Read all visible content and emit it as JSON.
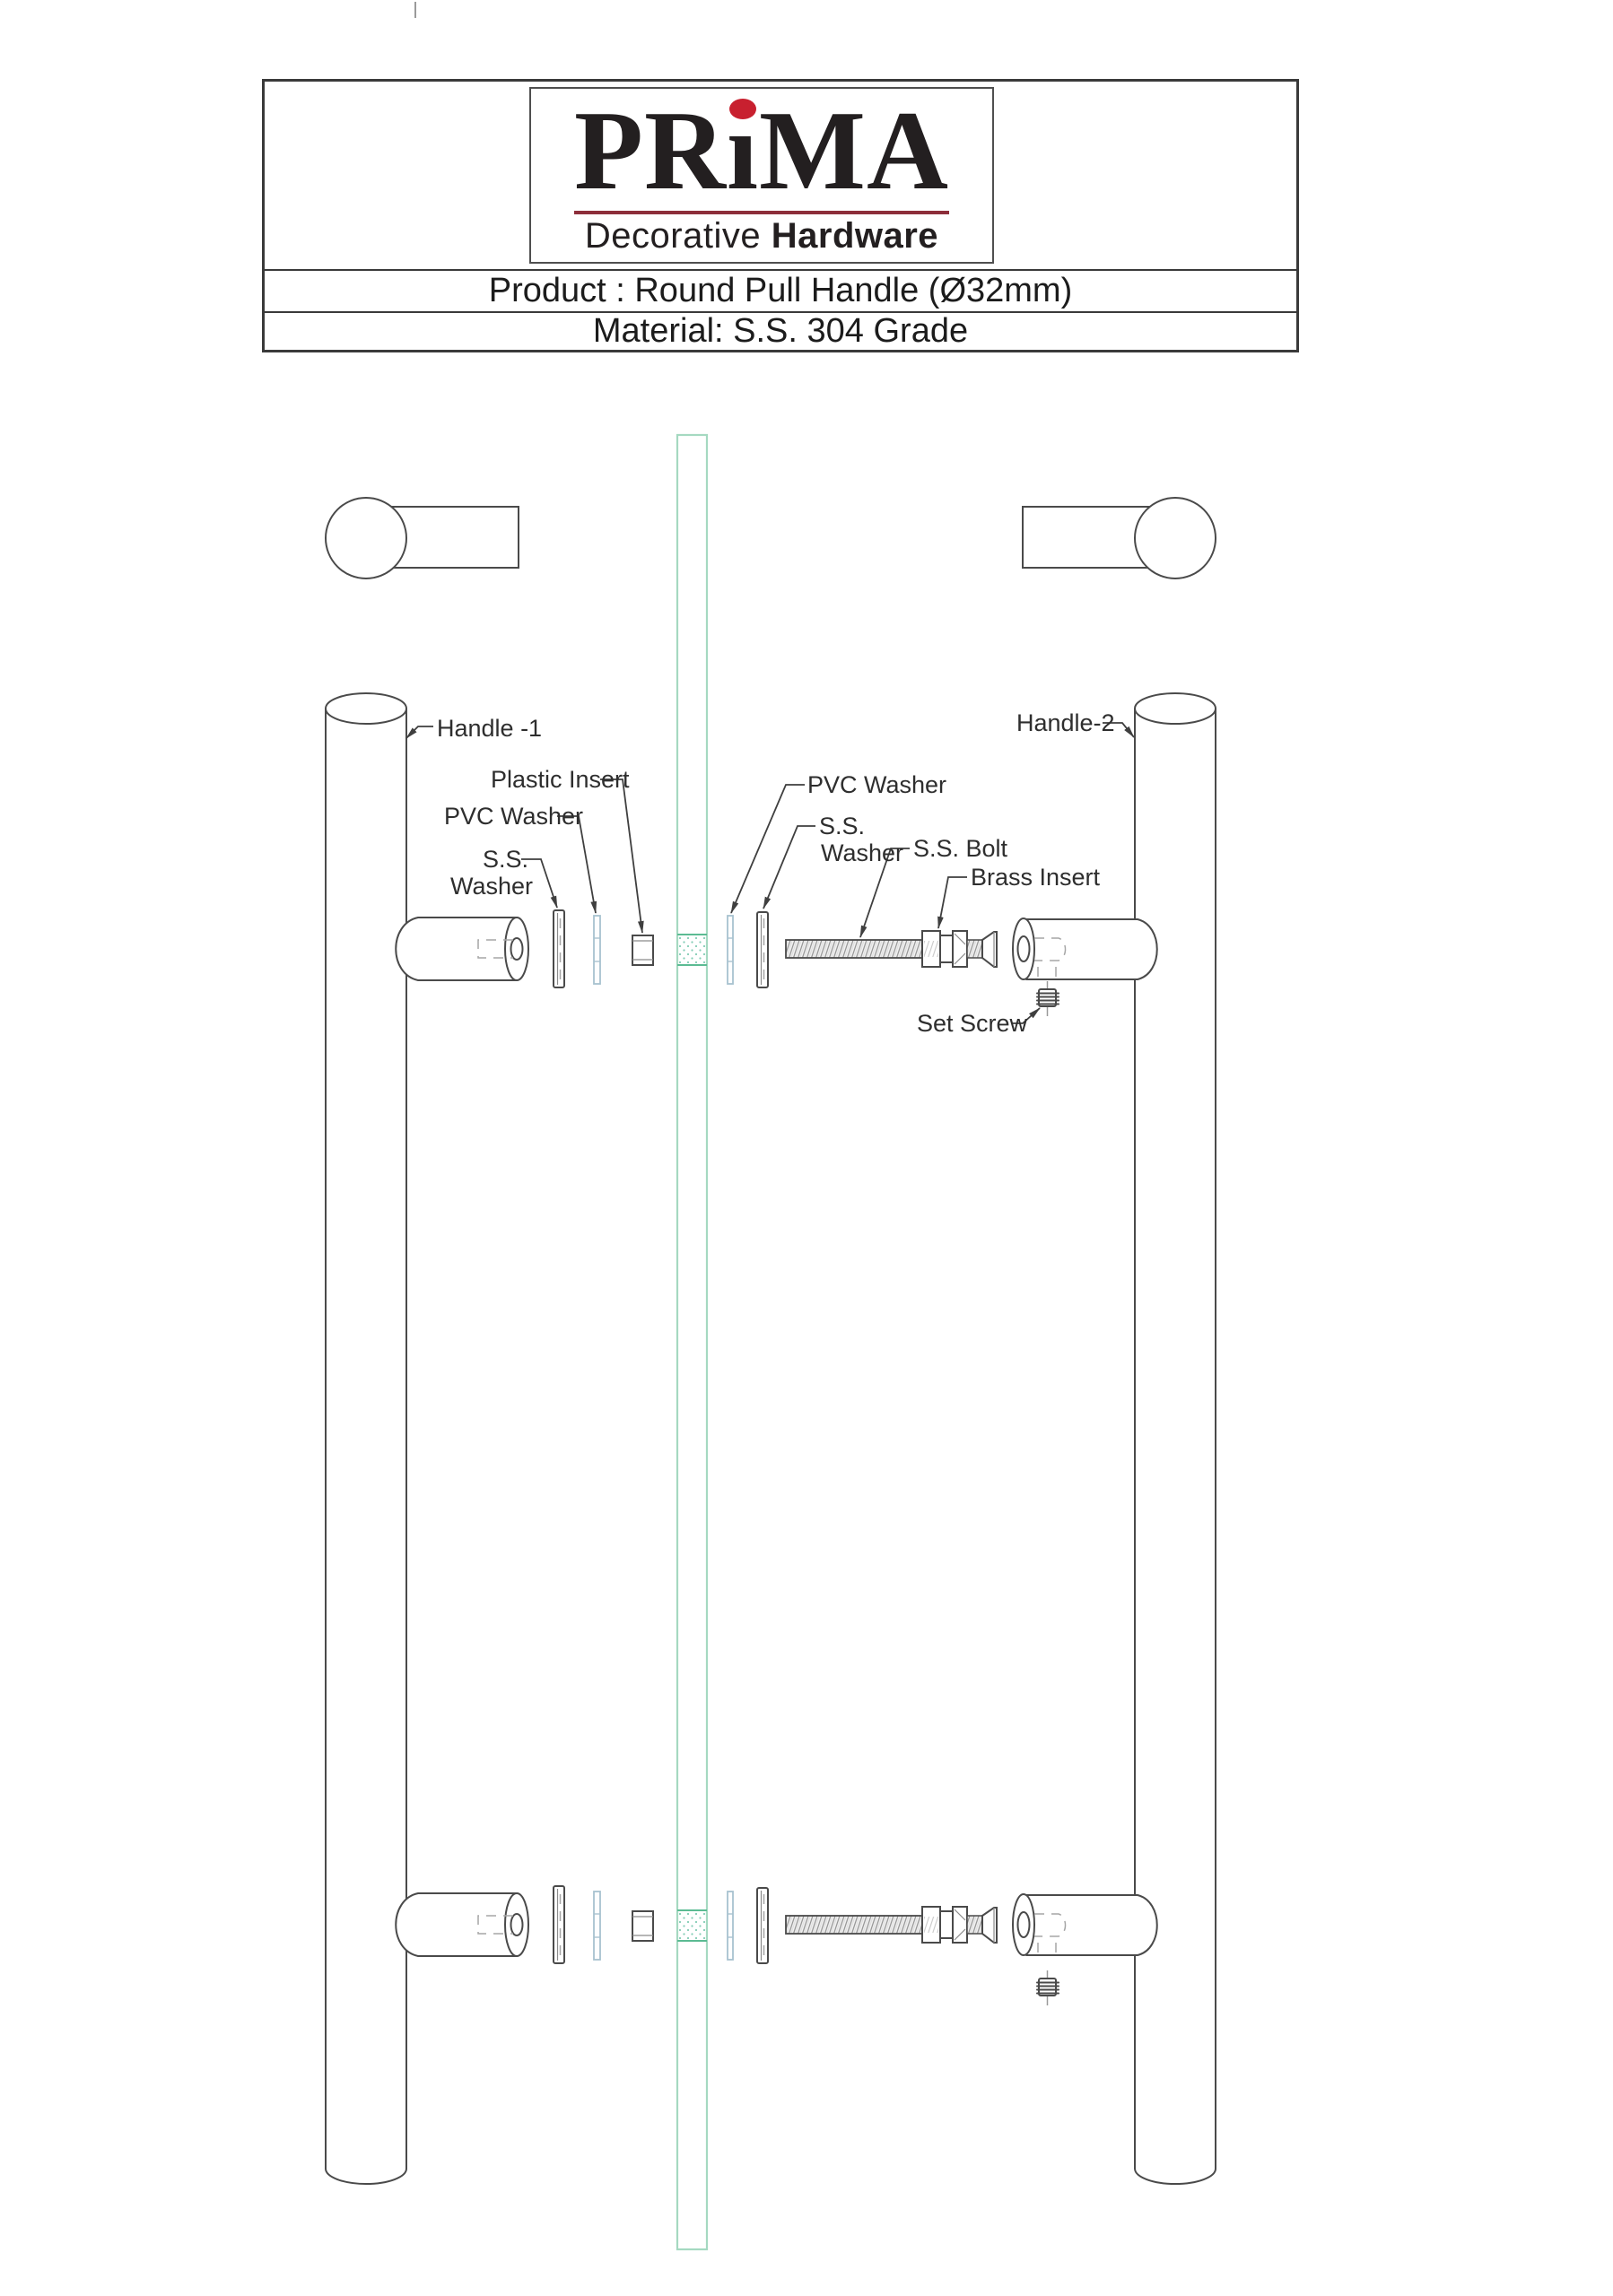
{
  "header": {
    "logo": {
      "part1": "PR",
      "part2": "ı",
      "part3": "MA",
      "tagline_regular": "Decorative",
      "tagline_bold": "Hardware"
    },
    "product_line": "Product : Round Pull Handle (Ø32mm)",
    "material_line": "Material: S.S. 304 Grade"
  },
  "diagram": {
    "labels": {
      "handle1": "Handle -1",
      "handle2": "Handle-2",
      "plastic_insert": "Plastic Insert",
      "pvc_washer_left": "PVC Washer",
      "ss_left_line1": "S.S.",
      "ss_left_line2": "Washer",
      "pvc_washer_right": "PVC Washer",
      "ss_right_line1": "S.S.",
      "ss_right_line2": "Washer",
      "ss_bolt": "S.S. Bolt",
      "brass_insert": "Brass Insert",
      "set_screw": "Set Screw"
    },
    "colors": {
      "line": "#4a4a4a",
      "glass_edge": "#a5d9c1",
      "glass_hole_edge": "#5cbb93",
      "glass_hatch_dot": "#82ccb4",
      "pvc_washer": "#a8c2cf",
      "logo_dot_red": "#c8202f",
      "logo_rule_maroon": "#8d2e3a"
    }
  }
}
